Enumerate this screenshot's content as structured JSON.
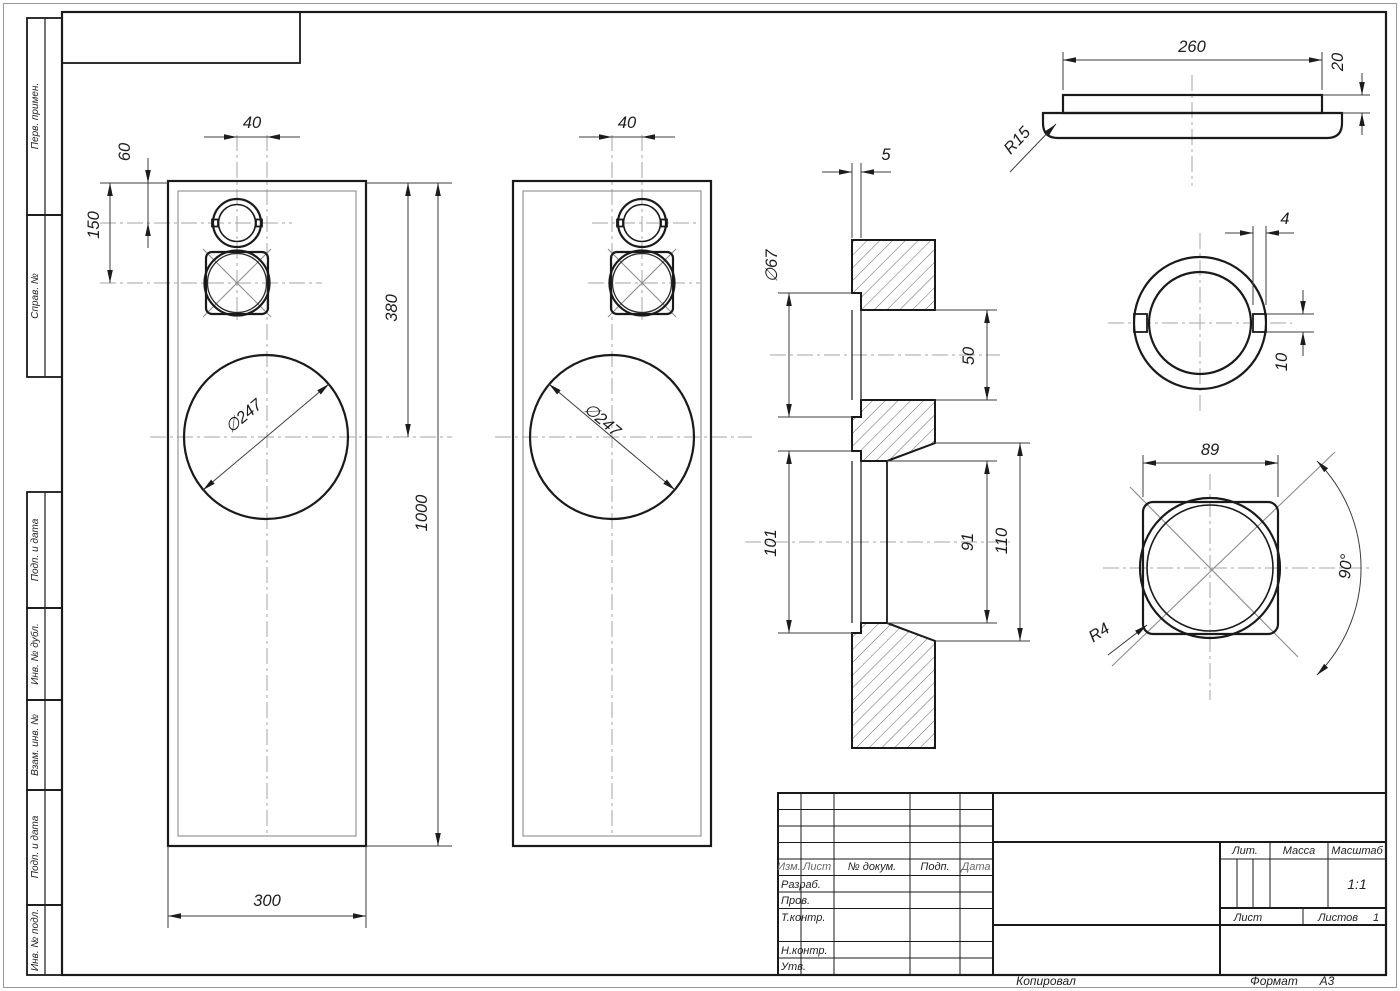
{
  "dims": {
    "p1_offset": "40",
    "p1_top_to_tweeter": "60",
    "p1_top_to_mid": "150",
    "p1_top_to_woofer": "380",
    "p1_height": "1000",
    "p1_width": "300",
    "p1_woofer_dia": "∅247",
    "p2_offset": "40",
    "p2_woofer_dia": "∅247",
    "sec_face_thickness": "5",
    "sec_tweeter_rebate_dia": "∅67",
    "sec_tweeter_dia": "50",
    "sec_mid_rebate_dia": "101",
    "sec_mid_dia": "91",
    "sec_mid_back_dia": "110",
    "sv_width": "260",
    "sv_thickness": "20",
    "sv_fillet": "R15",
    "d1_notch_depth": "4",
    "d1_notch_height": "10",
    "d2_width": "89",
    "d2_angle": "90°",
    "d2_corner_radius": "R4"
  },
  "stamp_sidebar": {
    "items": [
      "Перв. примен.",
      "Справ. №",
      "Подп. и дата",
      "Инв. № дубл.",
      "Взам. инв. №",
      "Подп. и дата",
      "Инв. № подл."
    ]
  },
  "title_block": {
    "col_izm": "Изм.",
    "col_list": "Лист",
    "col_doc": "№ докум.",
    "col_sign": "Подп.",
    "col_date": "Дата",
    "row_developed": "Разраб.",
    "row_checked": "Пров.",
    "row_tcontrol": "Т.контр.",
    "row_ncontrol": "Н.контр.",
    "row_approved": "Утв.",
    "lit_label": "Лит.",
    "mass_label": "Масса",
    "scale_label": "Масштаб",
    "scale_value": "1:1",
    "sheet_label": "Лист",
    "sheets_label": "Листов",
    "sheets_value": "1"
  },
  "footer": {
    "copied": "Копировал",
    "format_label": "Формат",
    "format_value": "А3"
  }
}
